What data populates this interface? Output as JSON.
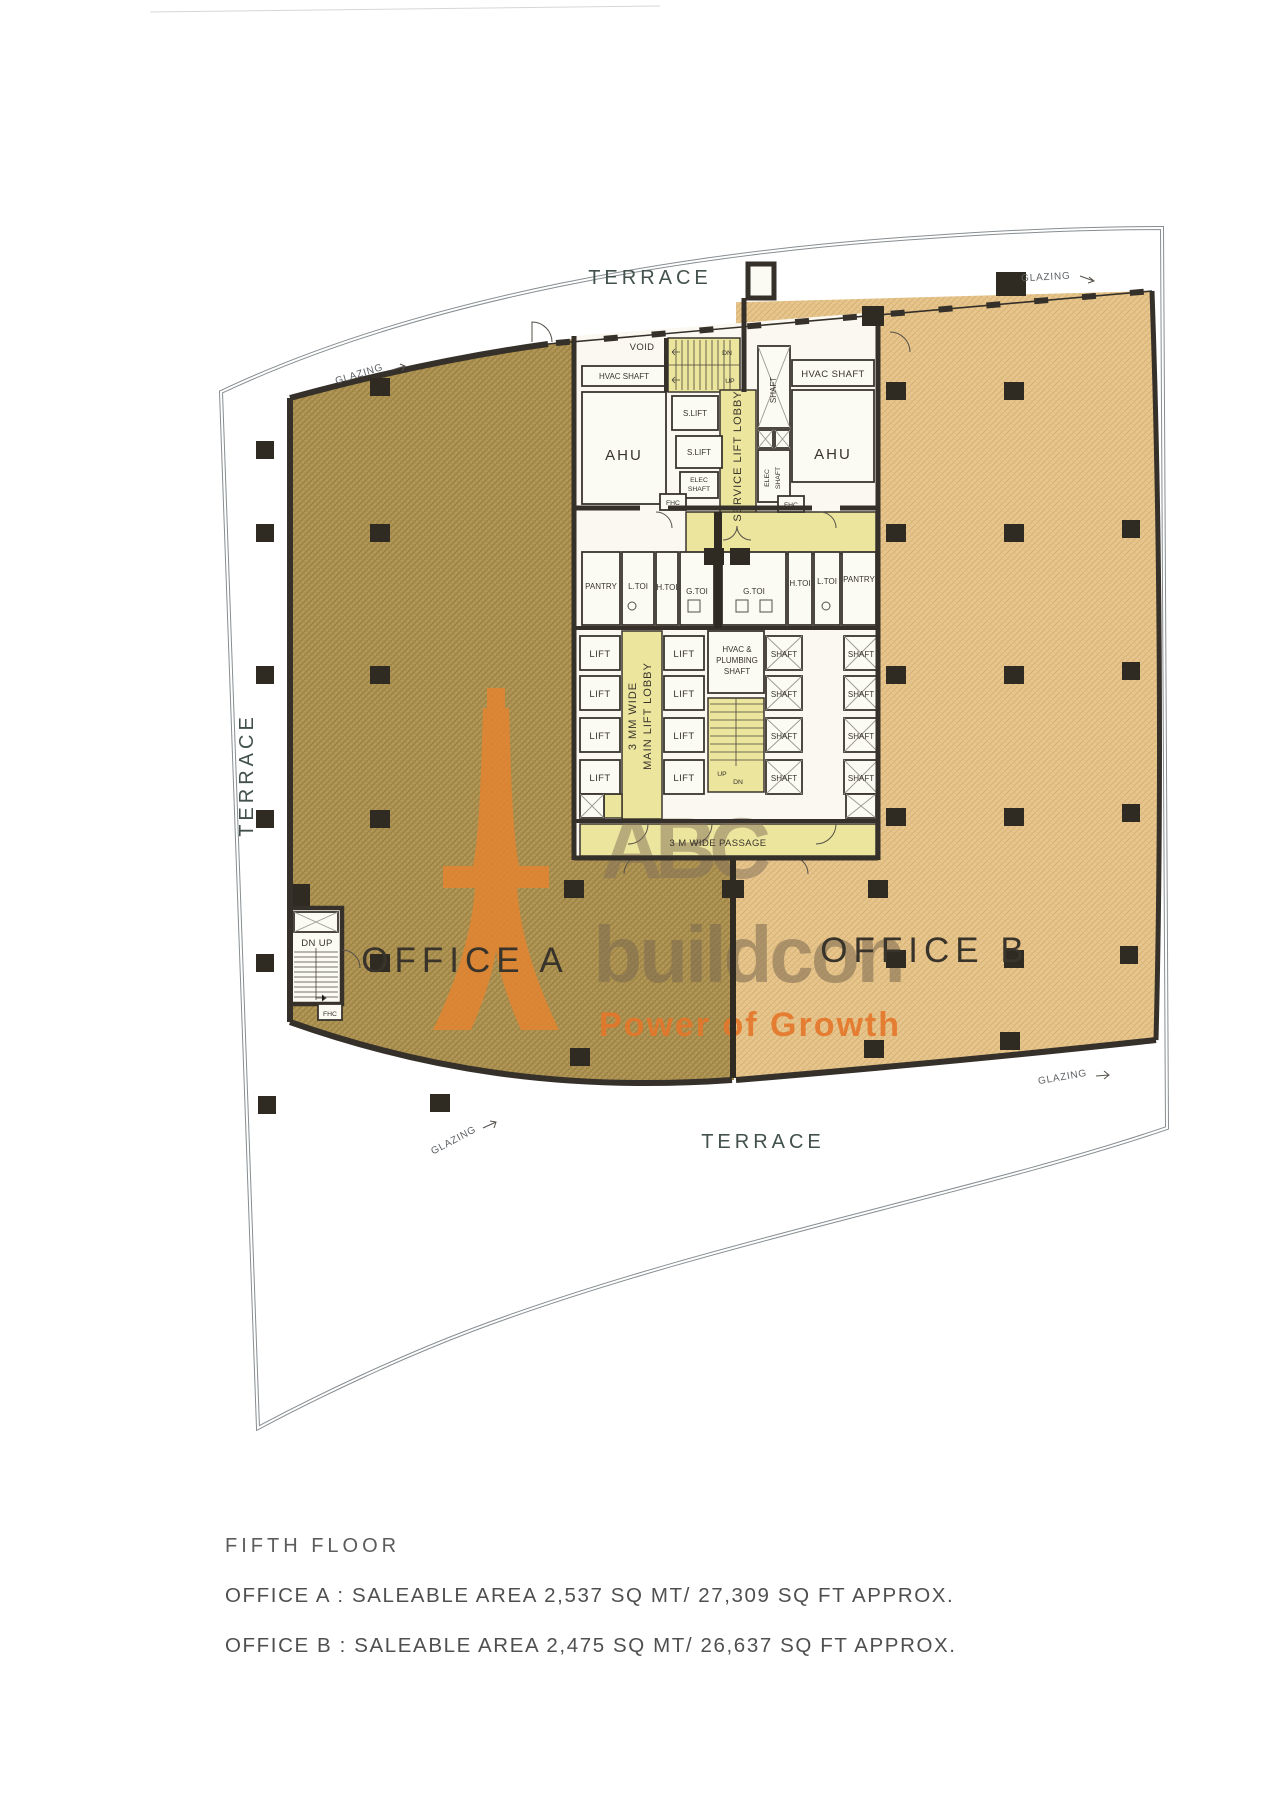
{
  "title_block": {
    "floor": "FIFTH FLOOR",
    "office_a": "OFFICE A : SALEABLE AREA 2,537 SQ MT/ 27,309 SQ FT APPROX.",
    "office_b": "OFFICE B : SALEABLE AREA 2,475 SQ MT/ 26,637 SQ FT APPROX."
  },
  "plan": {
    "terrace": "TERRACE",
    "glazing": "GLAZING",
    "office_a": "OFFICE A",
    "office_b": "OFFICE B",
    "void": "VOID",
    "hvac_shaft": "HVAC SHAFT",
    "ahu": "AHU",
    "s_lift": "S.LIFT",
    "service_lift_lobby": "SERVICE LIFT LOBBY",
    "shaft": "SHAFT",
    "elec": "ELEC",
    "fhc": "FHC",
    "dn": "DN",
    "up": "UP",
    "dn_up": "DN UP",
    "lift": "LIFT",
    "lobby_line1": "3 MM WIDE",
    "lobby_line2": "MAIN LIFT LOBBY",
    "hvac_plumbing": [
      "HVAC &",
      "PLUMBING",
      "SHAFT"
    ],
    "passage": "3 M WIDE PASSAGE",
    "toilets_left": [
      "PANTRY",
      "L.TOI",
      "H.TOI",
      "G.TOI"
    ],
    "toilets_right": [
      "G.TOI",
      "H.TOI",
      "L.TOI",
      "PANTRY"
    ]
  },
  "watermark": {
    "abc": "ABC",
    "buildcon": "buildcon",
    "tagline": "Power of Growth"
  },
  "colors": {
    "office_a_fill": "#b29758",
    "office_b_fill": "#e7c78f",
    "core_yellow": "#ece59d",
    "wall": "#35302a",
    "terrace_label": "#42514b",
    "watermark_orange": "#e5842f",
    "watermark_gray": "#83705a",
    "footer_text": "#545454"
  }
}
